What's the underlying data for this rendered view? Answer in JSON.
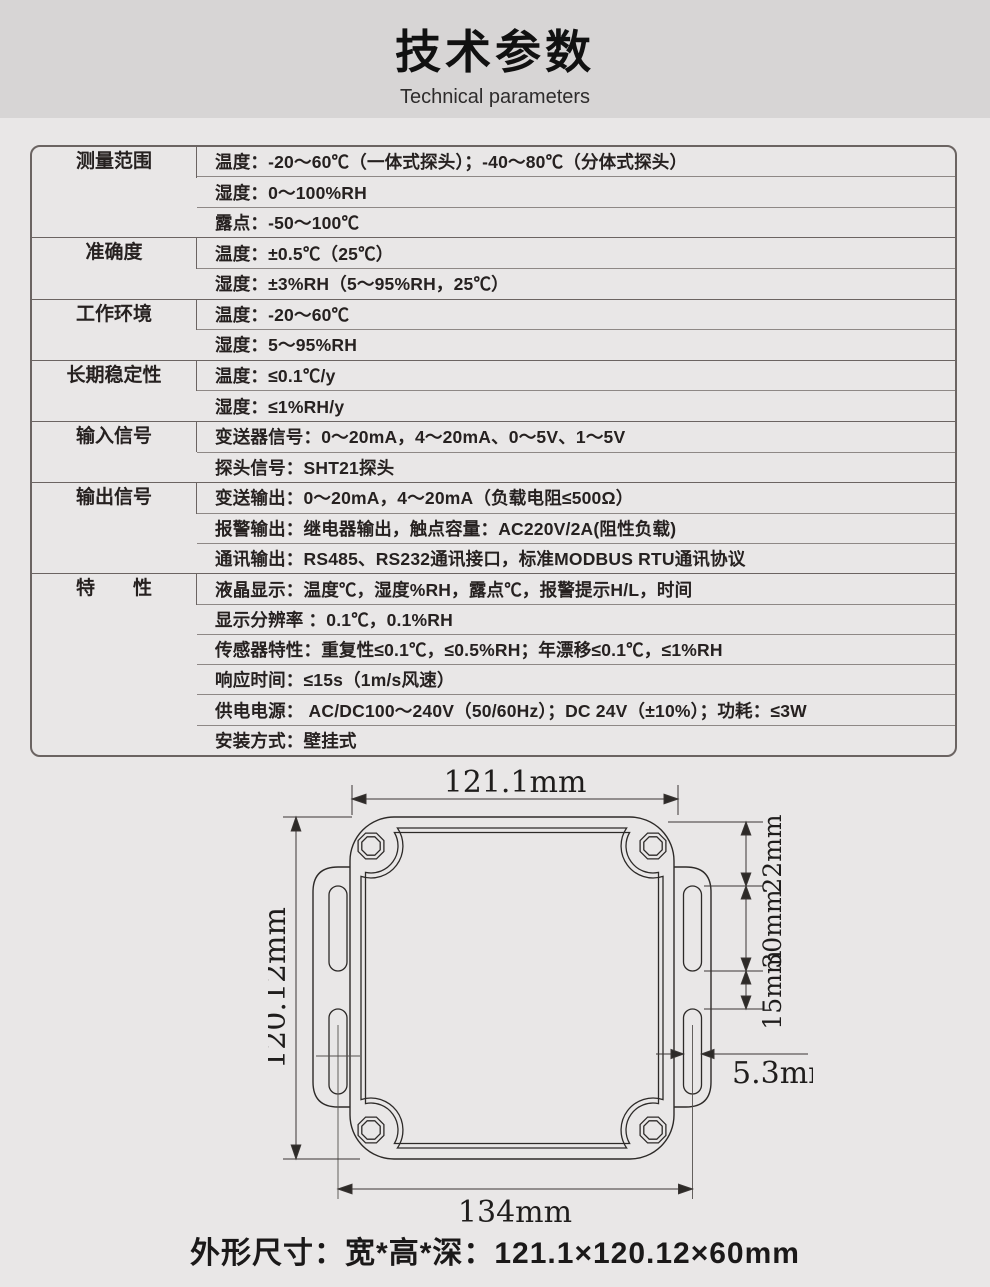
{
  "header": {
    "title": "技术参数",
    "subtitle": "Technical parameters"
  },
  "table": {
    "groups": [
      {
        "category": "测量范围",
        "rows": [
          "温度：-20～60℃（一体式探头）；-40～80℃（分体式探头）",
          "湿度：0～100%RH",
          "露点：-50～100℃"
        ]
      },
      {
        "category": "准确度",
        "rows": [
          "温度：±0.5℃（25℃）",
          "湿度：±3%RH（5～95%RH，25℃）"
        ]
      },
      {
        "category": "工作环境",
        "rows": [
          "温度：-20～60℃",
          "湿度：5～95%RH"
        ]
      },
      {
        "category": "长期稳定性",
        "rows": [
          "温度：≤0.1℃/y",
          "湿度：≤1%RH/y"
        ]
      },
      {
        "category": "输入信号",
        "rows": [
          "变送器信号：0～20mA，4～20mA、0～5V、1～5V",
          "探头信号：SHT21探头"
        ]
      },
      {
        "category": "输出信号",
        "rows": [
          "变送输出：0～20mA，4～20mA（负载电阻≤500Ω）",
          "报警输出：继电器输出，触点容量：AC220V/2A(阻性负载)",
          "通讯输出：RS485、RS232通讯接口，标准MODBUS RTU通讯协议"
        ]
      },
      {
        "category": "特　　性",
        "rows": [
          "液晶显示：温度℃，湿度%RH，露点℃，报警提示H/L，时间",
          "显示分辨率 ：0.1℃，0.1%RH",
          "传感器特性：重复性≤0.1℃，≤0.5%RH；年漂移≤0.1℃，≤1%RH",
          "响应时间：≤15s（1m/s风速）",
          "供电电源： AC/DC100～240V（50/60Hz）；DC 24V（±10%）；功耗：≤3W",
          "安装方式：壁挂式"
        ]
      }
    ]
  },
  "drawing": {
    "dims": {
      "width_top": "121.1mm",
      "height_left": "120.12mm",
      "seg_22": "22mm",
      "seg_30": "30mm",
      "seg_15": "15mm",
      "slot_width": "5.3mm",
      "width_bottom": "134mm"
    }
  },
  "footer": {
    "dimensions_label": "外形尺寸：宽*高*深：121.1×120.12×60mm"
  }
}
